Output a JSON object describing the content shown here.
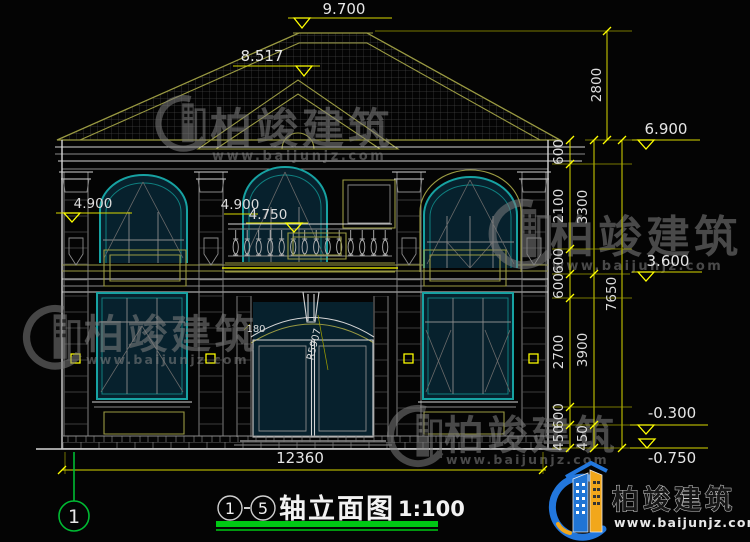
{
  "levels": {
    "ridge": "9.700",
    "roof_mid": "8.517",
    "eave": "6.900",
    "left_floor2": "4.900",
    "center_floor2": "4.900",
    "balcony": "4.750",
    "floor2": "3.600",
    "grade": "-0.300",
    "footing": "-0.750"
  },
  "dims": {
    "total_width": "12360",
    "roof_rise": "2800",
    "right_total": "7650",
    "chain_outer": [
      "3300",
      "3900",
      "450"
    ],
    "chain_inner": [
      "600",
      "2100",
      "600",
      "600",
      "2700",
      "600",
      "450"
    ],
    "arch_offset": "180",
    "arch_radius": "R5907"
  },
  "title_block": {
    "axis_from": "1",
    "axis_to": "5",
    "name": "轴立面图",
    "scale": "1:100"
  },
  "axis_bubble": {
    "label": "1"
  },
  "brand": {
    "name": "柏竣建筑",
    "url": "www.baijunjz.com"
  },
  "watermark": {
    "name": "柏竣建筑",
    "url": "www.baijunjz.com"
  },
  "colors": {
    "dimension_yellow": "#ffff00",
    "frame_cyan": "#17a2a2",
    "outline_olive": "#9a9a42",
    "title_green": "#00c814",
    "brand_blue": "#1f74d4",
    "brand_orange": "#f2a71b",
    "background": "#040404"
  }
}
